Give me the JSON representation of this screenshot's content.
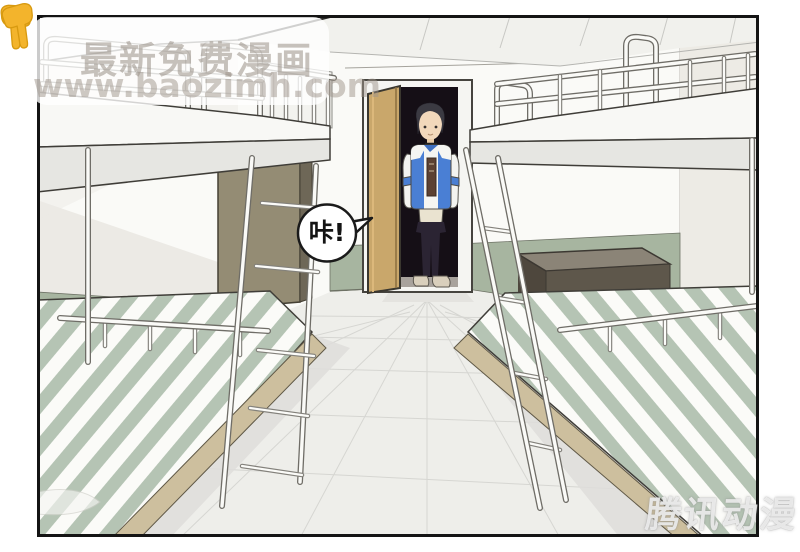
{
  "panel": {
    "border_color": "#141414",
    "background": "#ffffff"
  },
  "speech_bubble": {
    "text": "咔!"
  },
  "watermark_top": {
    "line1": "最新免费漫画",
    "line2": "www.baozimh.com"
  },
  "watermark_bottom": {
    "text": "腾讯动漫"
  },
  "colors": {
    "door": "#c9a76b",
    "wainscot_green": "#a7b5a0",
    "bed_stripe": "#b5c4b4",
    "jacket_blue": "#4a7fd4",
    "wardrobe_khaki": "#948c74",
    "desk_brown": "#5e574b",
    "floor": "#eeeeea",
    "watermark_hand": "#f3b42c"
  }
}
